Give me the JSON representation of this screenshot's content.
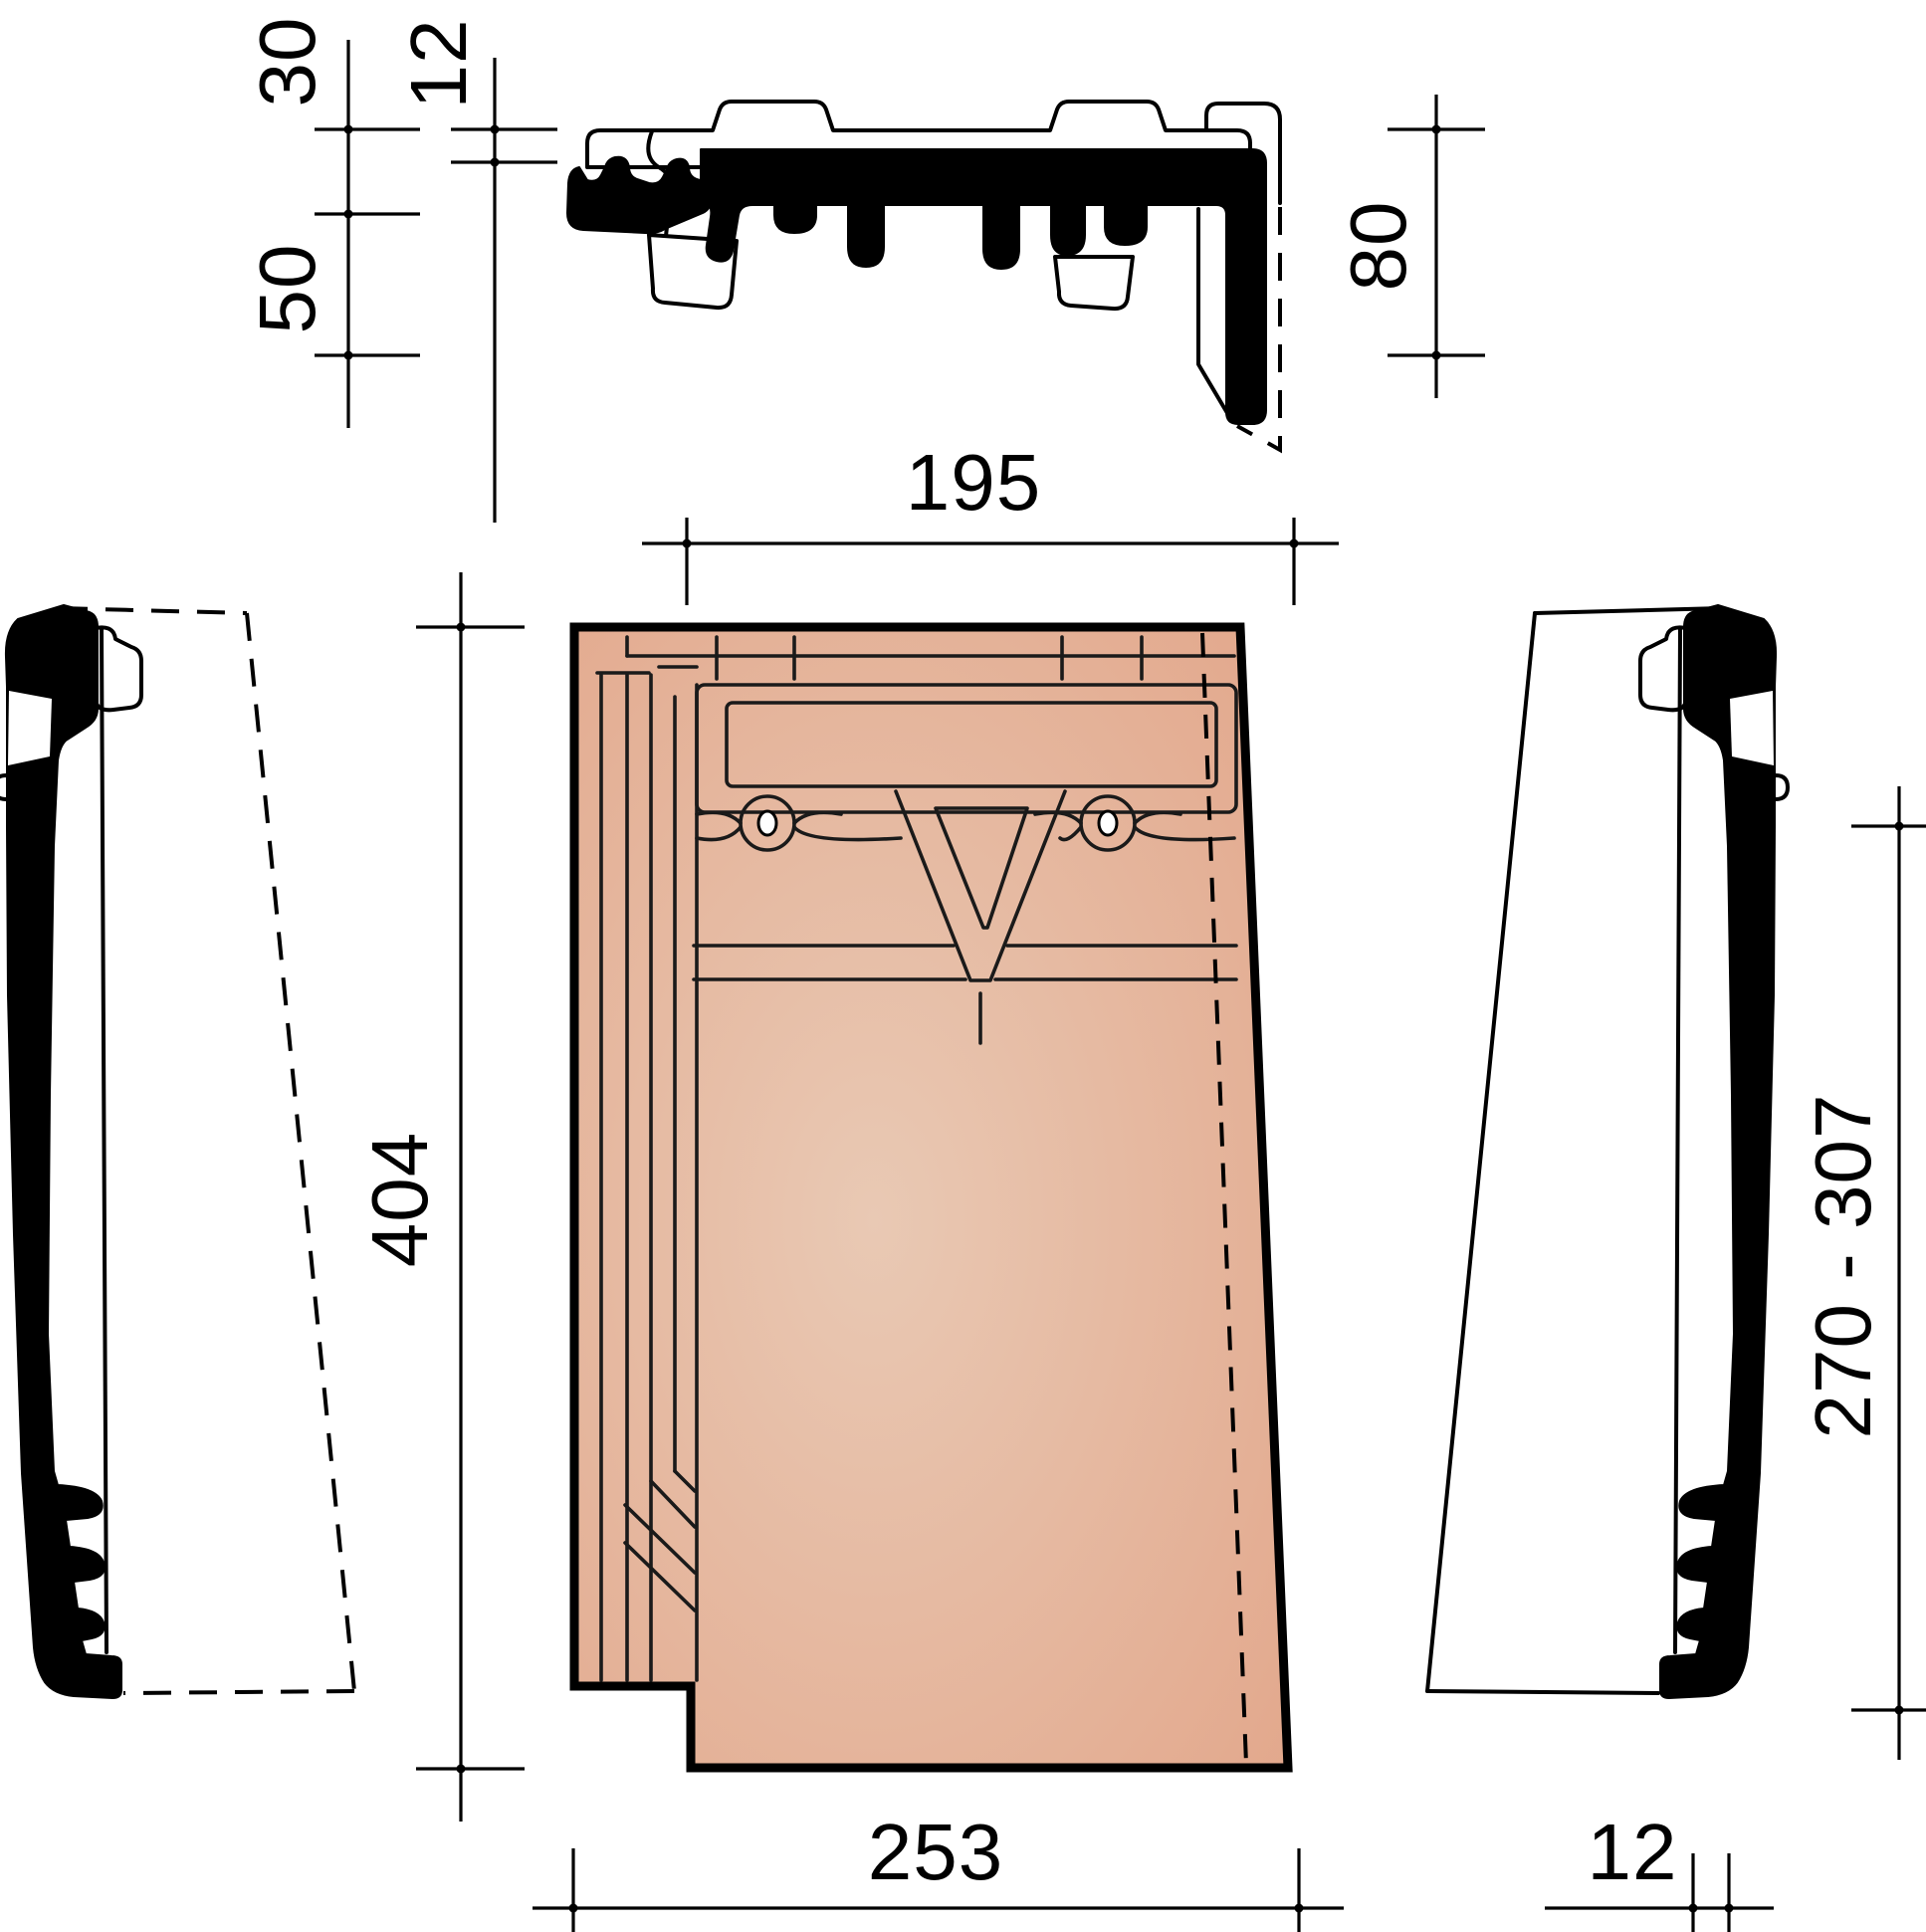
{
  "dims": {
    "v30": "30",
    "v12top": "12",
    "v50": "50",
    "v80": "80",
    "v195": "195",
    "v404": "404",
    "v253": "253",
    "v270_307": "270 - 307",
    "v12bottom": "12"
  },
  "colors": {
    "tile_center": "#e9c9b4",
    "tile_edge": "#e2a68a",
    "line": "#000000",
    "background": "#ffffff"
  }
}
